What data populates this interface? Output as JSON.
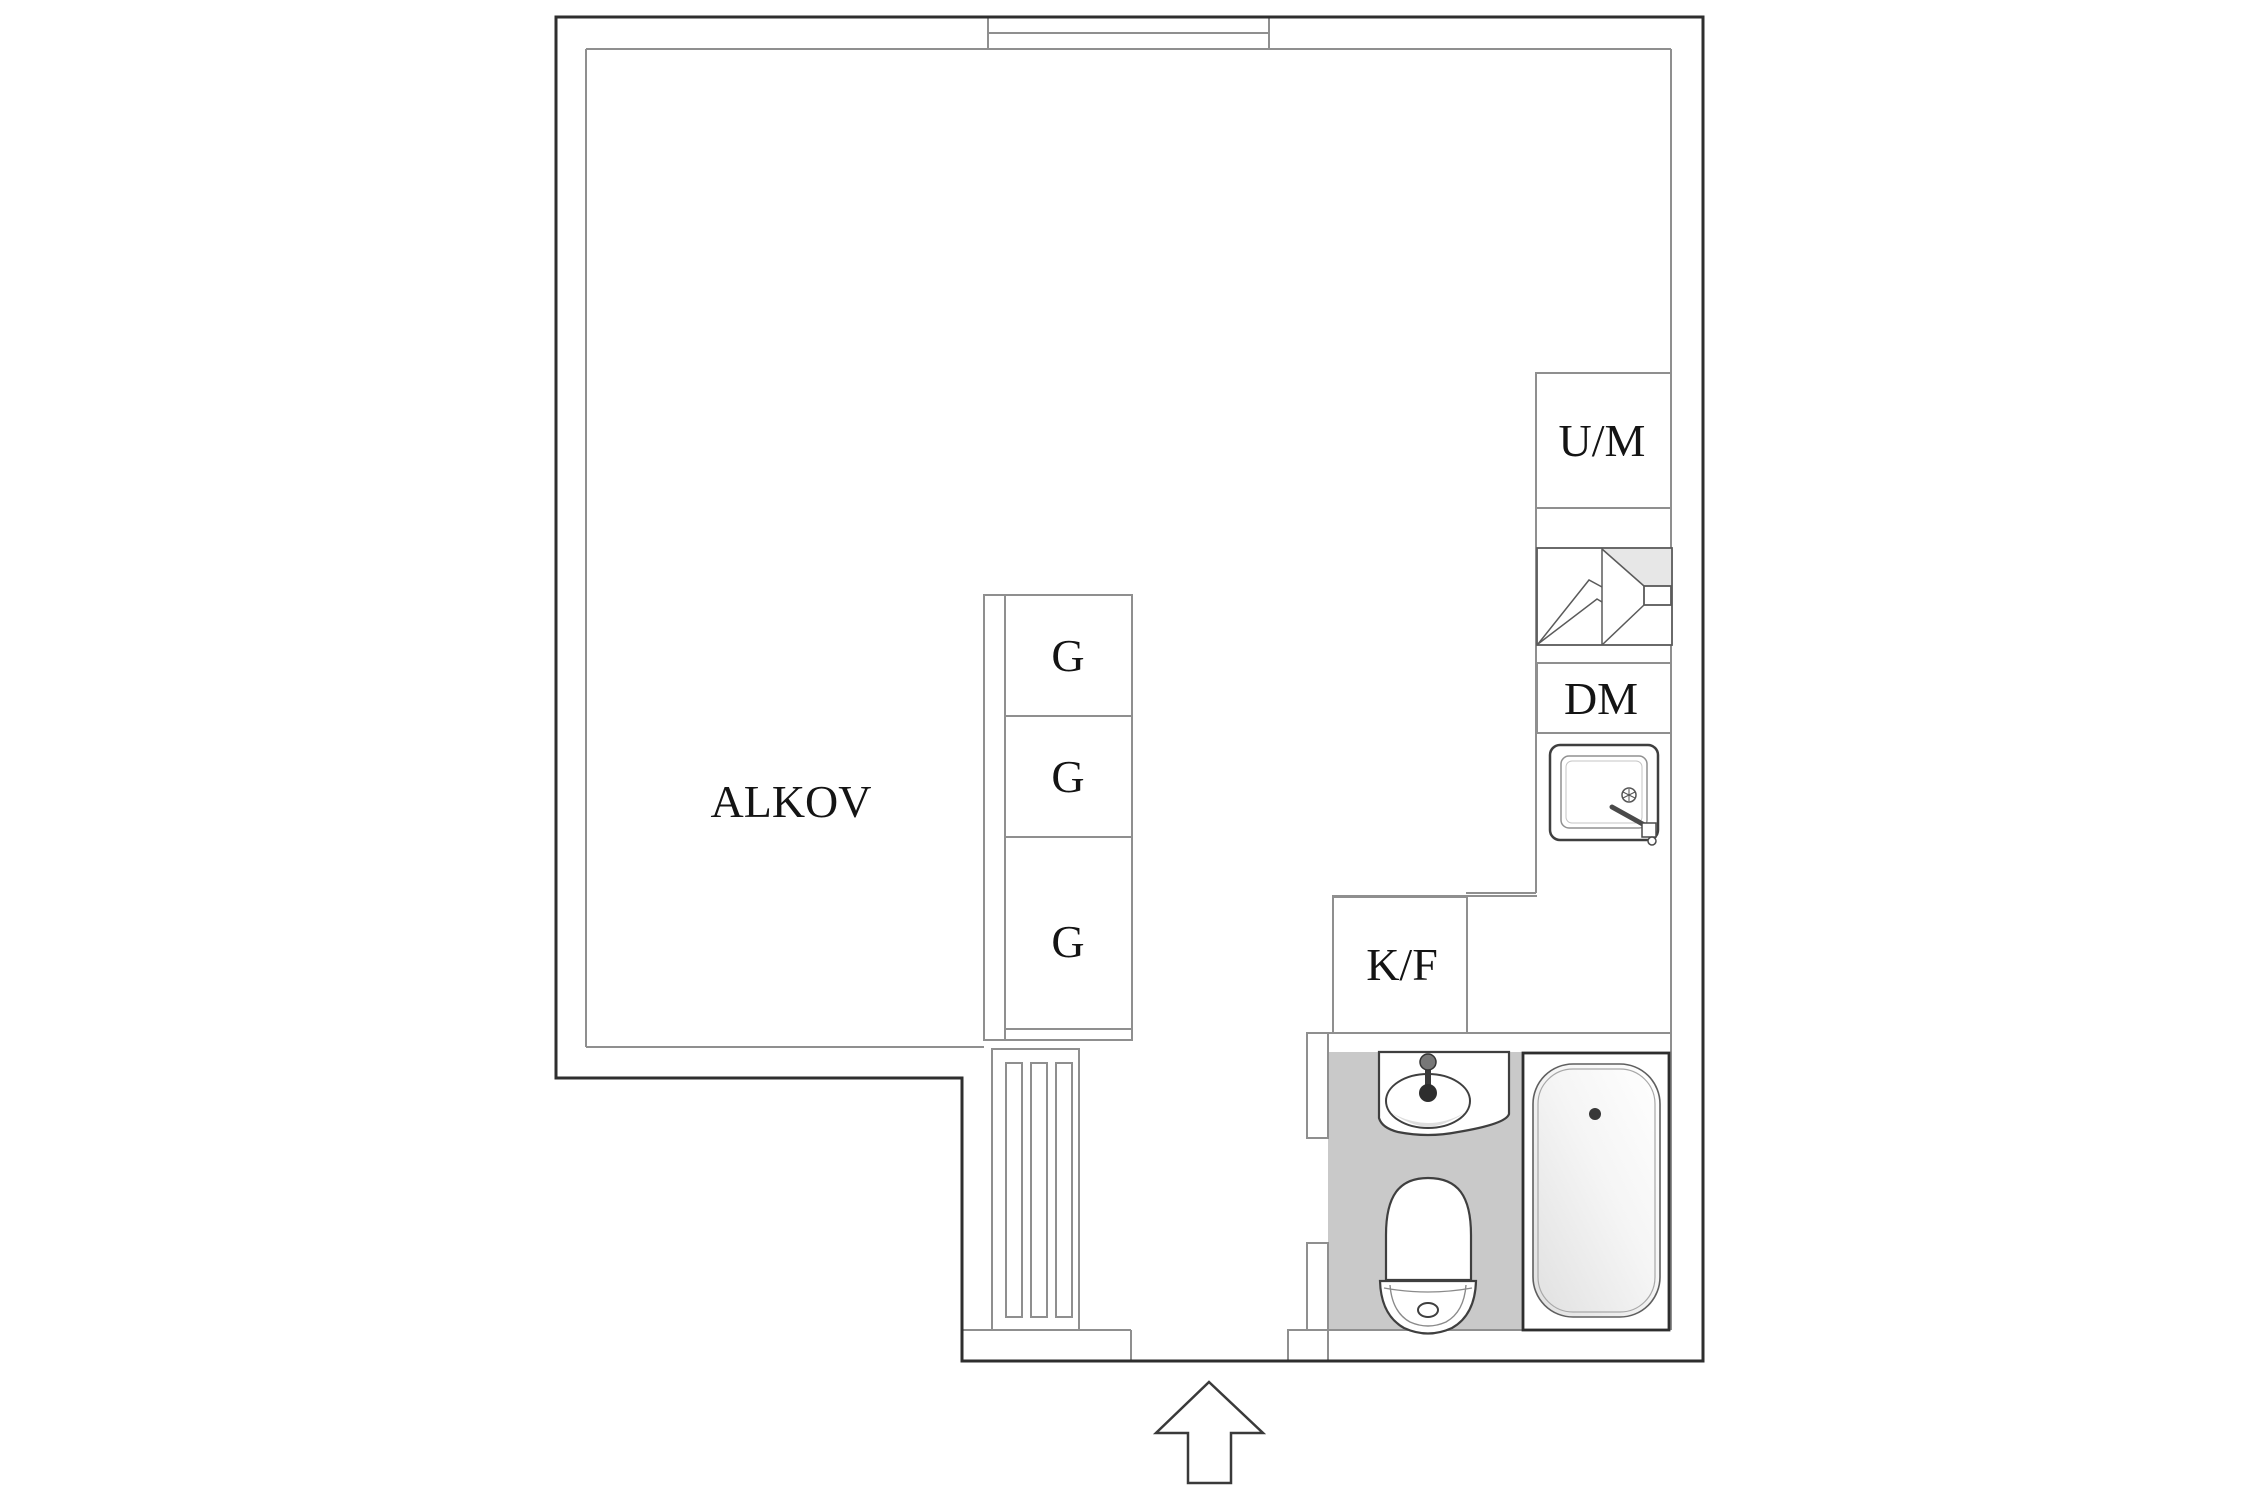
{
  "colors": {
    "background": "#ffffff",
    "wall_outline": "#2e2e2e",
    "partition_line": "#8f8f8f",
    "fixture_outline": "#3f3f3f",
    "bathroom_tile": "#c9c9c9",
    "shading_gray": "#e7e7e7",
    "label_text": "#141414"
  },
  "labels": {
    "alcove": "ALKOV",
    "wardrobes": [
      "G",
      "G",
      "G"
    ],
    "oven_microwave": "U/M",
    "dishwasher": "DM",
    "fridge_freezer": "K/F"
  },
  "icons": {
    "stove": "stove-icon",
    "kitchen_sink": "kitchen-sink-icon",
    "washbasin": "washbasin-icon",
    "toilet": "toilet-icon",
    "bathtub": "bathtub-icon",
    "window": "window-symbol",
    "slatted_panel": "slatted-panel",
    "entrance_arrow": "entrance-arrow-icon"
  }
}
